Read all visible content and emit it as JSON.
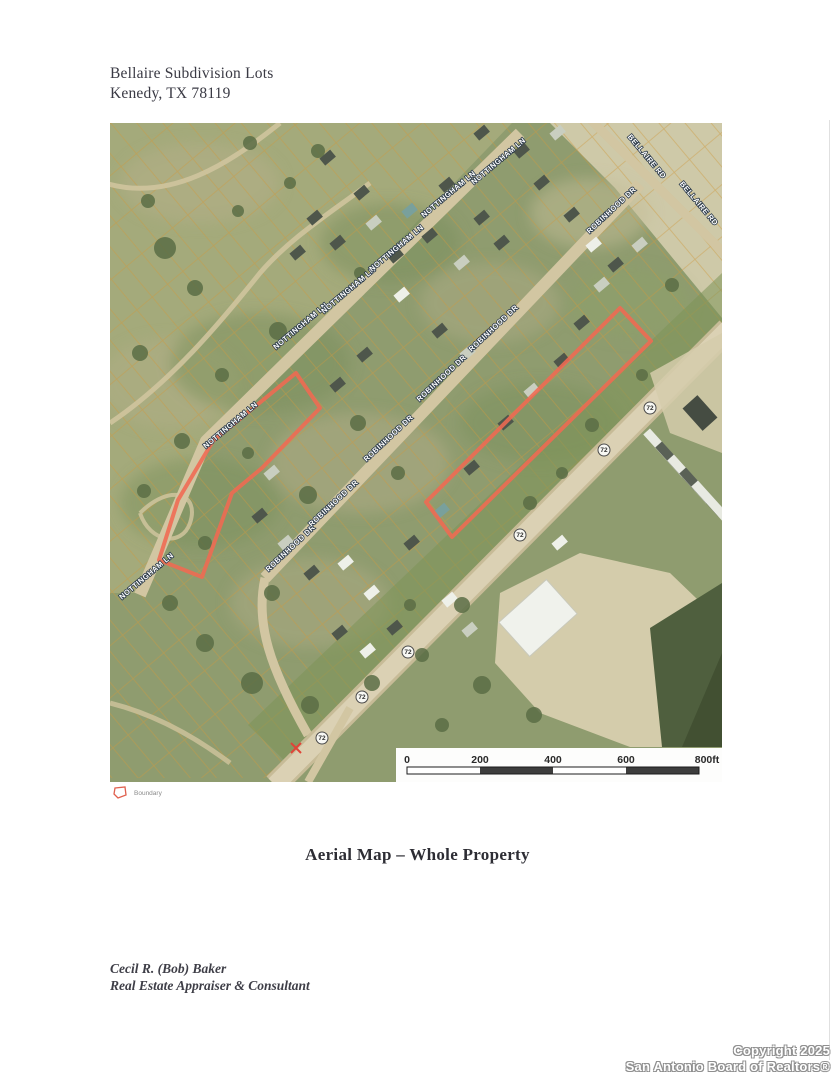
{
  "page": {
    "header": {
      "title": "Bellaire Subdivision Lots",
      "subtitle": "Kenedy, TX 78119"
    },
    "caption": "Aerial Map – Whole Property",
    "appraiser": {
      "name": "Cecil R. (Bob) Baker",
      "role": "Real Estate Appraiser & Consultant"
    },
    "copyright": {
      "line1": "Copyright 2025",
      "line2": "San Antonio Board of Realtors®"
    }
  },
  "legend": {
    "label": "Boundary",
    "swatch_color": "#e0604e"
  },
  "map": {
    "boundary_color": "#f06a52",
    "parcel_line_color": "#cf9a40",
    "scale_bar": {
      "ticks": [
        "0",
        "200",
        "400",
        "600",
        "800ft"
      ],
      "bar_dark_color": "#3d3d3d"
    },
    "route_shields": {
      "number": "72",
      "positions": [
        [
          540,
          285
        ],
        [
          494,
          327
        ],
        [
          410,
          412
        ],
        [
          298,
          529
        ],
        [
          252,
          574
        ],
        [
          212,
          615
        ]
      ]
    },
    "street_labels": [
      {
        "text": "NOTTINGHAM LN",
        "x": 38,
        "y": 455,
        "rot": -40
      },
      {
        "text": "NOTTINGHAM LN",
        "x": 122,
        "y": 304,
        "rot": -40
      },
      {
        "text": "NOTTINGHAM LN",
        "x": 192,
        "y": 205,
        "rot": -40
      },
      {
        "text": "NOTTINGHAM LN",
        "x": 240,
        "y": 169,
        "rot": -40
      },
      {
        "text": "NOTTINGHAM LN",
        "x": 288,
        "y": 127,
        "rot": -40
      },
      {
        "text": "NOTTINGHAM LN",
        "x": 340,
        "y": 73,
        "rot": -40
      },
      {
        "text": "NOTTINGHAM LN",
        "x": 390,
        "y": 40,
        "rot": -40
      },
      {
        "text": "ROBINHOOD DR",
        "x": 182,
        "y": 427,
        "rot": -43
      },
      {
        "text": "ROBINHOOD DR",
        "x": 225,
        "y": 382,
        "rot": -43
      },
      {
        "text": "ROBINHOOD DR",
        "x": 280,
        "y": 317,
        "rot": -43
      },
      {
        "text": "ROBINHOOD DR",
        "x": 333,
        "y": 257,
        "rot": -43
      },
      {
        "text": "ROBINHOOD DR",
        "x": 385,
        "y": 207,
        "rot": -43
      },
      {
        "text": "ROBINHOOD DR",
        "x": 503,
        "y": 89,
        "rot": -43
      },
      {
        "text": "BELLAIRE RD",
        "x": 535,
        "y": 35,
        "rot": 50
      },
      {
        "text": "BELLAIRE RD",
        "x": 587,
        "y": 82,
        "rot": 50
      }
    ],
    "boundaries": [
      {
        "name": "west-parcel",
        "points": [
          [
            186,
            250
          ],
          [
            210,
            285
          ],
          [
            152,
            345
          ],
          [
            122,
            370
          ],
          [
            92,
            454
          ],
          [
            49,
            437
          ],
          [
            68,
            377
          ],
          [
            103,
            318
          ]
        ]
      },
      {
        "name": "east-parcel",
        "points": [
          [
            510,
            185
          ],
          [
            541,
            218
          ],
          [
            342,
            414
          ],
          [
            316,
            379
          ]
        ]
      }
    ],
    "x_marker": {
      "x": 186,
      "y": 625
    }
  }
}
